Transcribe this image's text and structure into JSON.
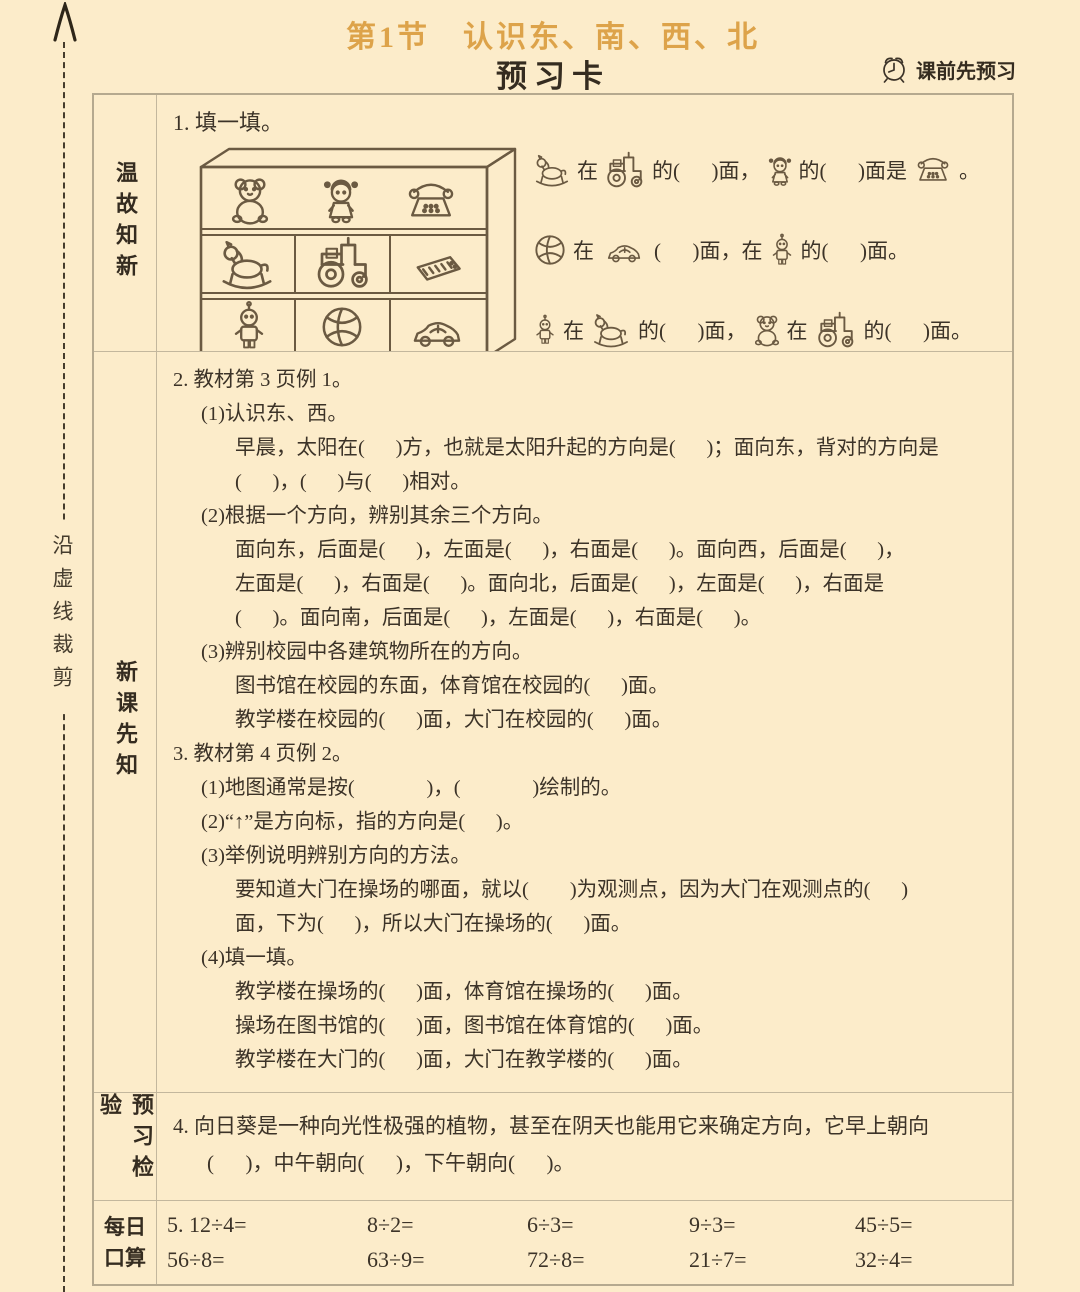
{
  "colors": {
    "background": "#fcecca",
    "title_accent": "#dda34a",
    "ink": "#3c3328",
    "table_border": "#c3b79d",
    "sketch_line": "#6b5a42"
  },
  "cut_strip": {
    "label": "沿虚线裁剪",
    "arrow_icon": "up-arrowhead"
  },
  "header": {
    "section_title": "第1节　认识东、南、西、北",
    "card_title": "预习卡",
    "reminder": "课前先预习",
    "reminder_icon": "alarm-clock"
  },
  "review": {
    "label": "温故知新",
    "q1_title": "1. 填一填。",
    "shelf": {
      "rows": [
        [
          "teddy-bear",
          "doll",
          "telephone"
        ],
        [
          "rocking-horse",
          "tractor",
          "electronic-keyboard"
        ],
        [
          "robot",
          "ball",
          "car"
        ]
      ]
    },
    "line1": {
      "icons": [
        "rocking-horse",
        "tractor",
        "doll",
        "telephone"
      ],
      "t0": "在",
      "t1": "的(      )面，",
      "t2": "的(      )面是",
      "t3": "。"
    },
    "line2": {
      "icons": [
        "ball",
        "car",
        "robot"
      ],
      "t0": "在",
      "t1": "(      )面，在",
      "t2": "的(      )面。"
    },
    "line3": {
      "icons": [
        "robot",
        "rocking-horse",
        "teddy-bear",
        "tractor"
      ],
      "t0": "在",
      "t1": "的(      )面，",
      "t2": "在",
      "t3": "的(      )面。"
    }
  },
  "study": {
    "label": "新课先知",
    "lines": [
      {
        "ind": 0,
        "t": "2. 教材第 3 页例 1。"
      },
      {
        "ind": 1,
        "t": "(1)认识东、西。"
      },
      {
        "ind": 2,
        "t": "早晨，太阳在(      )方，也就是太阳升起的方向是(      )；面向东，背对的方向是"
      },
      {
        "ind": 2,
        "t": "(      )，(      )与(      )相对。"
      },
      {
        "ind": 1,
        "t": "(2)根据一个方向，辨别其余三个方向。"
      },
      {
        "ind": 2,
        "t": "面向东，后面是(      )，左面是(      )，右面是(      )。面向西，后面是(      )，"
      },
      {
        "ind": 2,
        "t": "左面是(      )，右面是(      )。面向北，后面是(      )，左面是(      )，右面是"
      },
      {
        "ind": 2,
        "t": "(      )。面向南，后面是(      )，左面是(      )，右面是(      )。"
      },
      {
        "ind": 1,
        "t": "(3)辨别校园中各建筑物所在的方向。"
      },
      {
        "ind": 2,
        "t": "图书馆在校园的东面，体育馆在校园的(      )面。"
      },
      {
        "ind": 2,
        "t": "教学楼在校园的(      )面，大门在校园的(      )面。"
      },
      {
        "ind": 0,
        "t": "3. 教材第 4 页例 2。"
      },
      {
        "ind": 1,
        "t": "(1)地图通常是按(              )，(              )绘制的。"
      },
      {
        "ind": 1,
        "t": "(2)“↑”是方向标，指的方向是(      )。"
      },
      {
        "ind": 1,
        "t": "(3)举例说明辨别方向的方法。"
      },
      {
        "ind": 2,
        "t": "要知道大门在操场的哪面，就以(        )为观测点，因为大门在观测点的(      )"
      },
      {
        "ind": 2,
        "t": "面，下为(      )，所以大门在操场的(      )面。"
      },
      {
        "ind": 1,
        "t": "(4)填一填。"
      },
      {
        "ind": 2,
        "t": "教学楼在操场的(      )面，体育馆在操场的(      )面。"
      },
      {
        "ind": 2,
        "t": "操场在图书馆的(      )面，图书馆在体育馆的(      )面。"
      },
      {
        "ind": 2,
        "t": "教学楼在大门的(      )面，大门在教学楼的(      )面。"
      }
    ]
  },
  "check": {
    "label": "预习检验",
    "lines": [
      {
        "ind": 0,
        "t": "4. 向日葵是一种向光性极强的植物，甚至在阴天也能用它来确定方向，它早上朝向"
      },
      {
        "ind": 3,
        "t": "(      )，中午朝向(      )，下午朝向(      )。"
      }
    ]
  },
  "oral": {
    "label_line1": "每日",
    "label_line2": "口算",
    "rows": [
      [
        "5. 12÷4=",
        "8÷2=",
        "6÷3=",
        "9÷3=",
        "45÷5="
      ],
      [
        "56÷8=",
        "63÷9=",
        "72÷8=",
        "21÷7=",
        "32÷4="
      ]
    ]
  }
}
